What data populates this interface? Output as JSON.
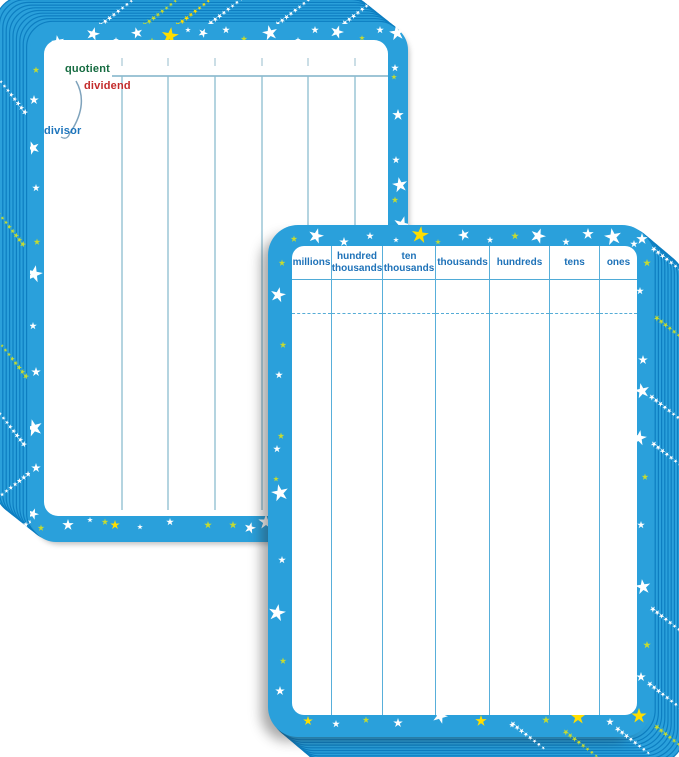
{
  "back_card": {
    "labels": {
      "quotient": "quotient",
      "dividend": "dividend",
      "divisor": "divisor"
    },
    "column_count": 7
  },
  "front_card": {
    "headers": [
      "millions",
      "hundred thousands",
      "ten thousands",
      "thousands",
      "hundreds",
      "tens",
      "ones"
    ],
    "column_count": 7
  },
  "colors": {
    "card_blue": "#2AA0DB",
    "stripe_edge": "#0D7EC1",
    "star_white": "#FFFFFF",
    "star_yellow": "#FFDE00",
    "star_lime": "#C6DB30",
    "back_line": "#8CBCD0",
    "back_line_dark": "#7FB2C9",
    "bracket_line": "#7FA3BC",
    "front_line": "#58AFDA",
    "header_text": "#1E72B8",
    "quotient_green": "#156B40",
    "dividend_red": "#C32A2A",
    "divisor_blue": "#1C74BC",
    "background": "#FFFFFF"
  }
}
